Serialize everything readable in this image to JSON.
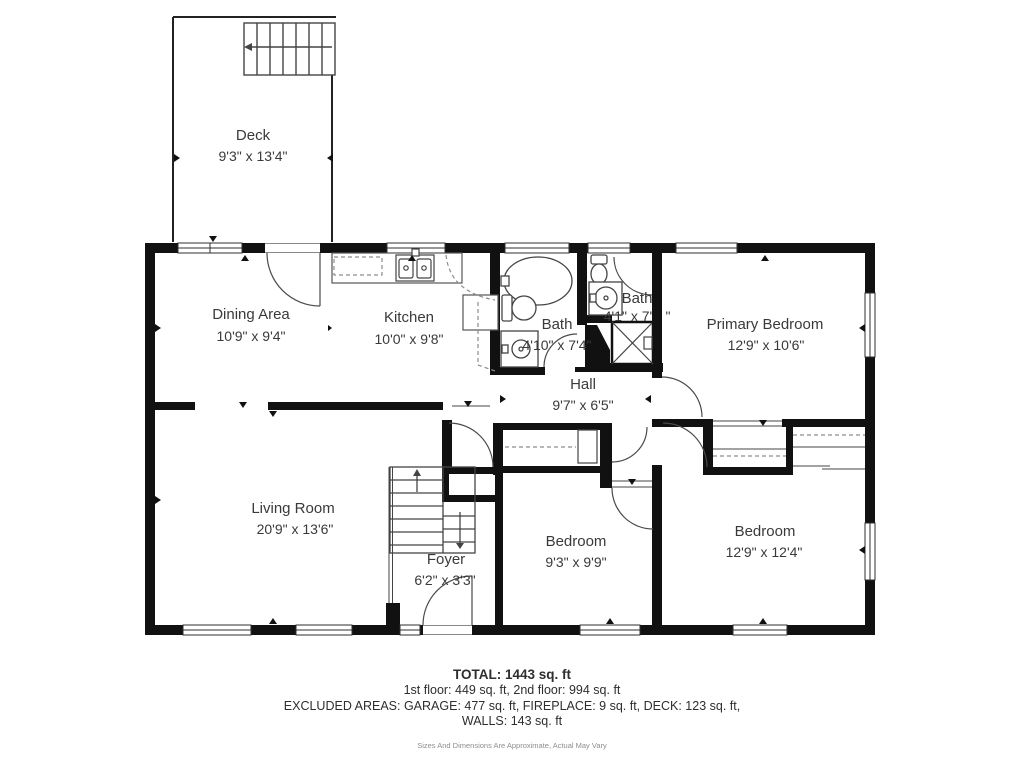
{
  "plan": {
    "rooms": [
      {
        "id": "deck",
        "name": "Deck",
        "dims": "9'3\" x 13'4\""
      },
      {
        "id": "dining",
        "name": "Dining Area",
        "dims": "10'9\" x 9'4\""
      },
      {
        "id": "kitchen",
        "name": "Kitchen",
        "dims": "10'0\" x 9'8\""
      },
      {
        "id": "bath-main",
        "name": "Bath",
        "dims": "4'10\" x 7'4\""
      },
      {
        "id": "bath-small",
        "name": "Bath",
        "dims": "4'1\" x 7'",
        "dims_tail": "\""
      },
      {
        "id": "hall",
        "name": "Hall",
        "dims": "9'7\" x 6'5\""
      },
      {
        "id": "primary-bedroom",
        "name": "Primary Bedroom",
        "dims": "12'9\" x 10'6\""
      },
      {
        "id": "living-room",
        "name": "Living Room",
        "dims": "20'9\" x 13'6\""
      },
      {
        "id": "foyer",
        "name": "Foyer",
        "dims": "6'2\" x 3'3\""
      },
      {
        "id": "bedroom-1",
        "name": "Bedroom",
        "dims": "9'3\" x 9'9\""
      },
      {
        "id": "bedroom-2",
        "name": "Bedroom",
        "dims": "12'9\" x 12'4\""
      }
    ]
  },
  "footer": {
    "total": "TOTAL: 1443 sq. ft",
    "floors": "1st floor: 449 sq. ft, 2nd floor: 994 sq. ft",
    "excluded": "EXCLUDED AREAS: GARAGE: 477 sq. ft, FIREPLACE: 9 sq. ft, DECK: 123 sq. ft,",
    "walls": "WALLS: 143 sq. ft",
    "disclaimer": "Sizes And Dimensions Are Approximate, Actual May Vary"
  },
  "colors": {
    "wall": "#111111",
    "line": "#3d3d3d",
    "text": "#3a3a3a",
    "muted": "#8d8d8d",
    "background": "#ffffff"
  }
}
